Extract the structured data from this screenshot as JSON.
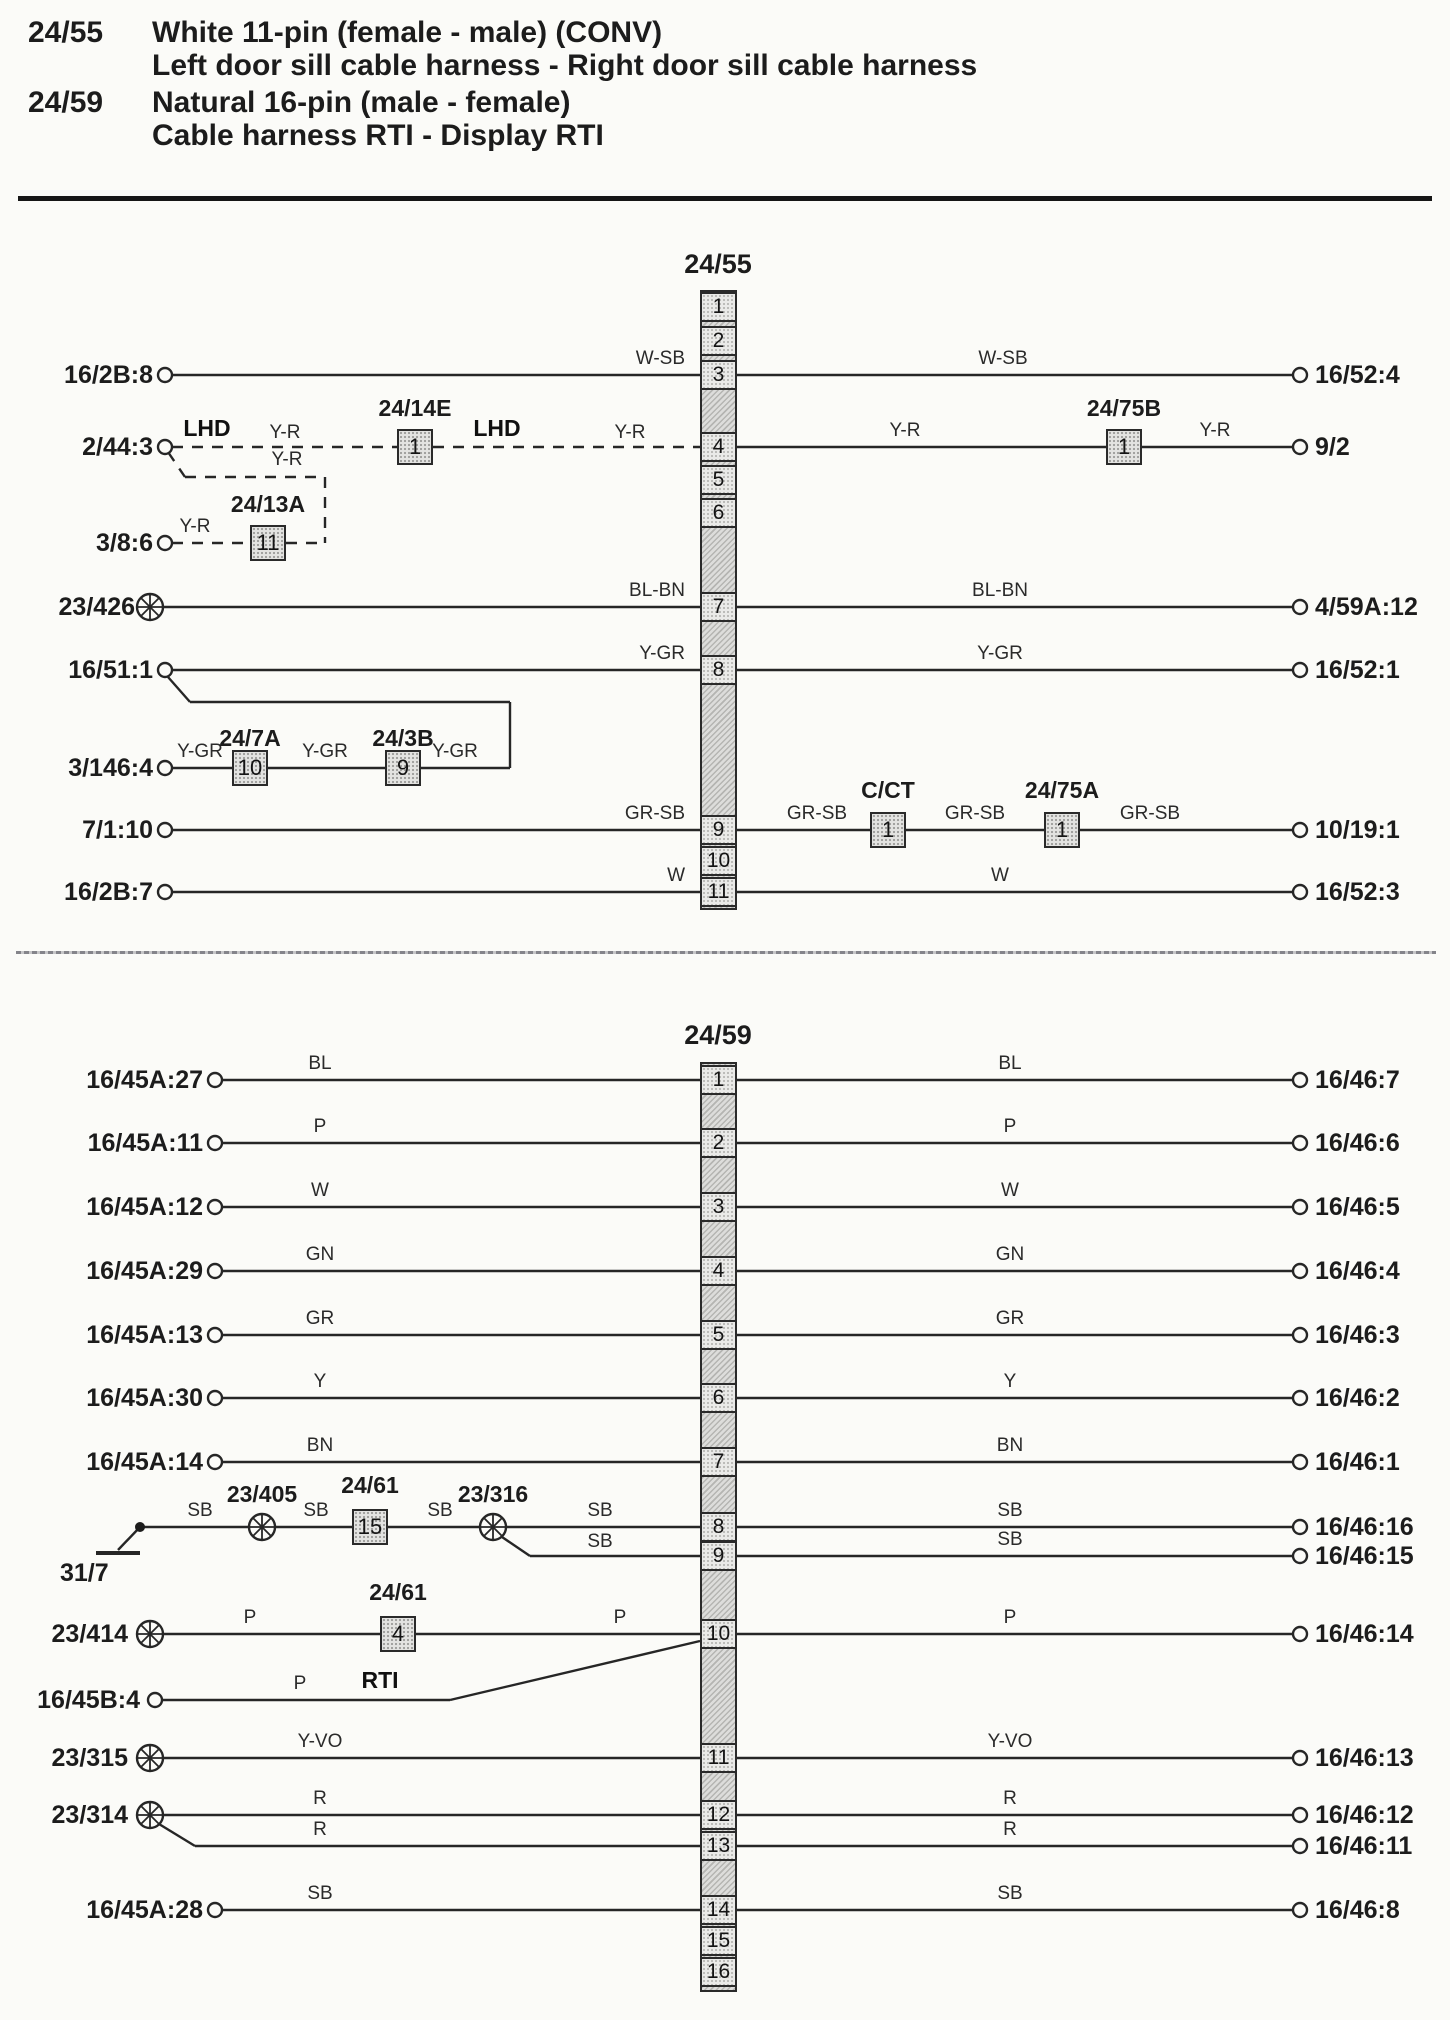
{
  "header": {
    "entries": [
      {
        "id": "24/55",
        "line1": "White 11-pin (female - male) (CONV)",
        "line2": "Left door sill cable harness - Right door sill cable harness"
      },
      {
        "id": "24/59",
        "line1": "Natural 16-pin (male - female)",
        "line2": "Cable harness RTI - Display RTI"
      }
    ]
  },
  "d1": {
    "connector": "24/55",
    "pins": [
      "1",
      "2",
      "3",
      "4",
      "5",
      "6",
      "7",
      "8",
      "9",
      "10",
      "11"
    ],
    "left": {
      "p3": "16/2B:8",
      "p4": "2/44:3",
      "p386": "3/8:6",
      "p7": "23/426",
      "p8": "16/51:1",
      "p3146": "3/146:4",
      "p9": "7/1:10",
      "p11": "16/2B:7"
    },
    "right": {
      "p3": "16/52:4",
      "p4": "9/2",
      "p7": "4/59A:12",
      "p8": "16/52:1",
      "p9": "10/19:1",
      "p11": "16/52:3"
    },
    "wires": {
      "p3l": "W-SB",
      "p3r": "W-SB",
      "lhd1": "LHD",
      "p4c1": "Y-R",
      "lhd2": "LHD",
      "p4c2": "Y-R",
      "p4r1": "Y-R",
      "p4r2": "Y-R",
      "br": "Y-R",
      "p386c": "Y-R",
      "p7l": "BL-BN",
      "p7r": "BL-BN",
      "p8l": "Y-GR",
      "p8r": "Y-GR",
      "s1": "Y-GR",
      "s2": "Y-GR",
      "s3": "Y-GR",
      "p9l": "GR-SB",
      "p9m1": "GR-SB",
      "p9m2": "GR-SB",
      "p9m3": "GR-SB",
      "p11l": "W",
      "p11r": "W"
    },
    "components": {
      "b14e": {
        "label": "24/14E",
        "num": "1"
      },
      "b13a": {
        "label": "24/13A",
        "num": "11"
      },
      "b75b": {
        "label": "24/75B",
        "num": "1"
      },
      "b7a": {
        "label": "24/7A",
        "num": "10"
      },
      "b3b": {
        "label": "24/3B",
        "num": "9"
      },
      "cct": {
        "label": "C/CT",
        "num": "1"
      },
      "b75a": {
        "label": "24/75A",
        "num": "1"
      }
    }
  },
  "d2": {
    "connector": "24/59",
    "pins": [
      "1",
      "2",
      "3",
      "4",
      "5",
      "6",
      "7",
      "8",
      "9",
      "10",
      "11",
      "12",
      "13",
      "14",
      "15",
      "16"
    ],
    "rows": [
      {
        "left": "16/45A:27",
        "lc": "BL",
        "rc": "BL",
        "right": "16/46:7"
      },
      {
        "left": "16/45A:11",
        "lc": "P",
        "rc": "P",
        "right": "16/46:6"
      },
      {
        "left": "16/45A:12",
        "lc": "W",
        "rc": "W",
        "right": "16/46:5"
      },
      {
        "left": "16/45A:29",
        "lc": "GN",
        "rc": "GN",
        "right": "16/46:4"
      },
      {
        "left": "16/45A:13",
        "lc": "GR",
        "rc": "GR",
        "right": "16/46:3"
      },
      {
        "left": "16/45A:30",
        "lc": "Y",
        "rc": "Y",
        "right": "16/46:2"
      },
      {
        "left": "16/45A:14",
        "lc": "BN",
        "rc": "BN",
        "right": "16/46:1"
      }
    ],
    "row8": {
      "ground": "31/7",
      "c1": "SB",
      "splice1": "23/405",
      "c2": "SB",
      "box": {
        "label": "24/61",
        "num": "15"
      },
      "c3": "SB",
      "splice2": "23/316",
      "c4": "SB",
      "rc": "SB",
      "right": "16/46:16"
    },
    "row9": {
      "lc": "SB",
      "rc": "SB",
      "right": "16/46:15"
    },
    "row10": {
      "left": "23/414",
      "c1": "P",
      "box": {
        "label": "24/61",
        "num": "4"
      },
      "c2": "P",
      "rc": "P",
      "right": "16/46:14"
    },
    "rowRti": {
      "left": "16/45B:4",
      "c": "P",
      "tag": "RTI"
    },
    "row11": {
      "left": "23/315",
      "lc": "Y-VO",
      "rc": "Y-VO",
      "right": "16/46:13"
    },
    "row12": {
      "left": "23/314",
      "lc": "R",
      "rc": "R",
      "right": "16/46:12"
    },
    "row13": {
      "lc": "R",
      "rc": "R",
      "right": "16/46:11"
    },
    "row14": {
      "left": "16/45A:28",
      "lc": "SB",
      "rc": "SB",
      "right": "16/46:8"
    }
  }
}
